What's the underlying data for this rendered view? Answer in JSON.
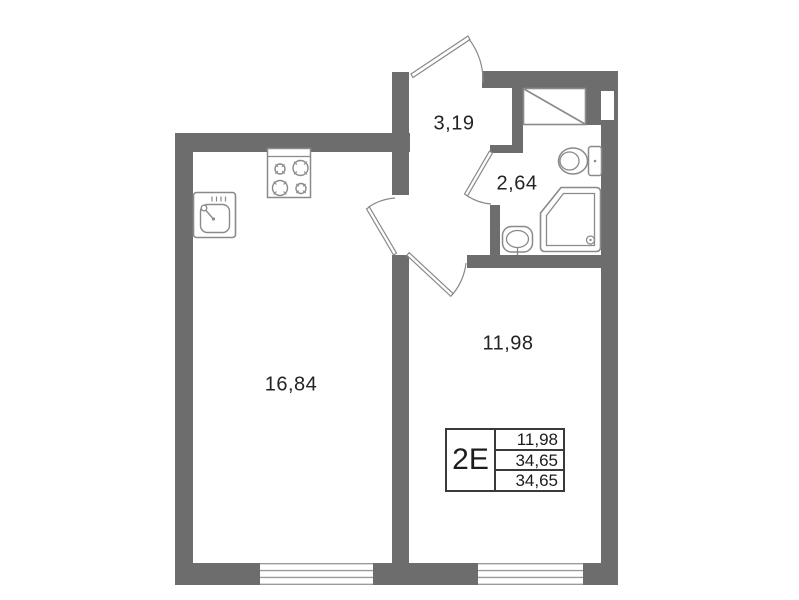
{
  "plan": {
    "rooms": [
      {
        "name": "entrance-hall",
        "area": "3,19"
      },
      {
        "name": "bathroom",
        "area": "2,64"
      },
      {
        "name": "living-kitchen",
        "area": "16,84"
      },
      {
        "name": "bedroom",
        "area": "11,98"
      }
    ],
    "legend": {
      "apartment_type": "2Е",
      "rows": [
        "11,98",
        "34,65",
        "34,65"
      ]
    },
    "colors": {
      "wall": "#6d6d6d",
      "fixture_line": "#8a8a8a",
      "window_line": "#9b9b9b",
      "text": "#232323",
      "table_border": "#3a3a3a"
    },
    "icons": [
      "stove-icon",
      "kitchen-sink-icon",
      "toilet-icon",
      "shower-tray-icon",
      "washbasin-icon",
      "vent-shaft-icon"
    ]
  }
}
